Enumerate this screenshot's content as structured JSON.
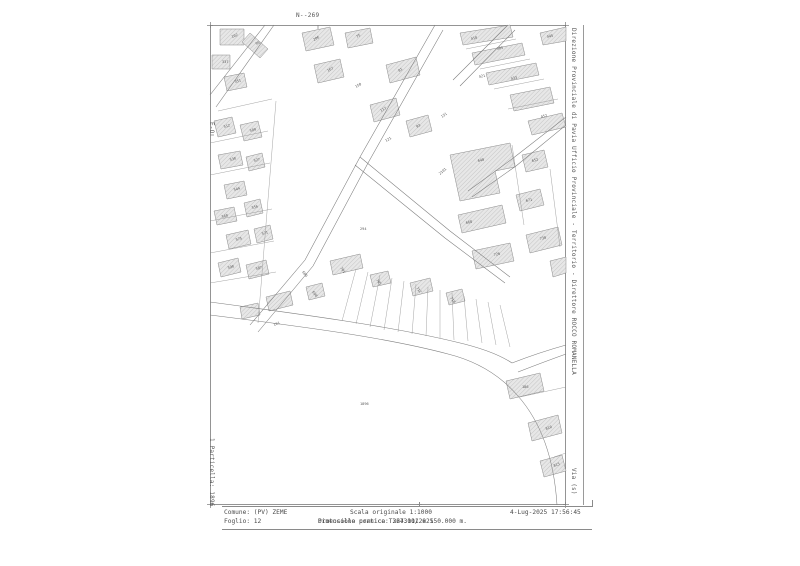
{
  "sheet": {
    "top_grid_label": "N--269",
    "right_margin_text": "Direzione Provinciale di Pavia  Ufficio Provinciale - Territorio - Direttore ROCCO ROMANELLA",
    "right_margin_bottom_text": "Via (s)",
    "left_margin_top_text": "E-O",
    "left_margin_bottom_text": "1 Particella: 1896"
  },
  "footer": {
    "comune": "Comune: (PV) ZEME",
    "foglio": "Foglio: 12",
    "scala": "Scala originale  1:1000",
    "cornice": "Dimensione cornice: 267.001 x 150.000 m.",
    "protocollo": "Protocollo pratica T324311/2025",
    "timestamp": "4-Lug-2025 17:56:45"
  },
  "map": {
    "line_color": "#7c7c7c",
    "building_fill": "#e7e7e7",
    "hatch_color": "#bdbdbd",
    "roads": [
      "M55 0 L0 70",
      "M64 0 L6 82",
      "M225 0 L150 132 L95 235 L40 300",
      "M233 5 L158 138 L103 241 L48 307",
      "M150 132 L240 206 L300 252",
      "M145 140 L235 213 L295 258",
      "M298 0 L243 55",
      "M305 5 L250 61",
      "M356 92 L302 134 L258 166",
      "M356 100 L306 141 L262 172",
      "M0 277 C90 289 180 301 246 317 C272 323 290 330 302 338",
      "M0 290 C88 301 174 312 238 329 C266 336 290 350 308 371 C330 396 344 432 347 480",
      "M302 338 C320 331 338 325 356 320",
      "M308 347 C326 340 342 334 356 329"
    ],
    "buildings": [
      "10,4 34,4 34,20 10,20",
      "40,8 58,24 50,33 32,17",
      "2,30 20,30 20,44 2,44",
      "14,52 34,48 37,62 17,66",
      "4,96 22,92 26,108 8,112",
      "30,100 48,96 52,112 34,116",
      "8,130 30,126 33,140 11,144",
      "36,132 52,128 55,142 39,146",
      "14,160 34,156 37,170 17,174",
      "4,186 24,182 27,196 7,200",
      "34,178 50,174 53,188 37,192",
      "16,210 38,205 41,219 19,224",
      "44,204 60,200 63,214 47,218",
      "8,238 28,233 31,247 11,252",
      "36,240 56,235 59,249 39,254",
      "92,8 120,2 124,20 96,26",
      "104,40 130,34 134,52 108,58",
      "135,8 160,3 163,18 138,23",
      "176,40 206,32 210,50 180,58",
      "160,80 186,73 190,90 164,97",
      "196,96 218,90 222,106 200,112",
      "250,8 300,0 303,12 253,20",
      "262,28 312,18 315,30 265,40",
      "276,48 326,38 329,50 279,60",
      "330,8 356,2 356,16 333,20",
      "300,70 340,62 344,78 304,86",
      "318,96 352,88 356,102 322,110",
      "240,130 300,118 305,142 285,146 290,168 250,176",
      "312,130 334,125 338,142 316,147",
      "248,190 292,180 296,198 252,208",
      "306,170 330,164 334,180 310,186",
      "120,236 150,229 153,243 123,250",
      "160,250 178,246 181,258 163,262",
      "200,258 220,253 223,266 203,271",
      "236,268 252,264 255,276 239,280",
      "96,262 112,258 115,271 99,275",
      "262,226 300,218 304,236 266,244",
      "316,210 348,202 352,220 320,228",
      "296,356 330,348 334,366 300,374",
      "318,398 348,390 352,408 322,416",
      "330,436 352,430 356,446 334,452",
      "56,272 80,266 83,280 59,286",
      "30,282 48,278 50,290 32,294",
      "340,236 356,232 356,248 343,252"
    ],
    "parcel_lines": [
      [
        146,
        244,
        132,
        296
      ],
      [
        158,
        247,
        146,
        299
      ],
      [
        170,
        250,
        160,
        302
      ],
      [
        182,
        253,
        174,
        305
      ],
      [
        194,
        256,
        188,
        307
      ],
      [
        206,
        259,
        202,
        309
      ],
      [
        218,
        262,
        216,
        311
      ],
      [
        230,
        265,
        230,
        313
      ],
      [
        242,
        268,
        244,
        315
      ],
      [
        254,
        271,
        258,
        316
      ],
      [
        266,
        274,
        272,
        318
      ],
      [
        278,
        277,
        286,
        320
      ],
      [
        290,
        280,
        300,
        322
      ],
      [
        0,
        118,
        58,
        106
      ],
      [
        0,
        150,
        60,
        138
      ],
      [
        0,
        196,
        62,
        184
      ],
      [
        0,
        228,
        64,
        216
      ],
      [
        0,
        258,
        66,
        247
      ],
      [
        8,
        86,
        62,
        74
      ],
      [
        66,
        76,
        48,
        298
      ],
      [
        256,
        24,
        306,
        14
      ],
      [
        270,
        44,
        320,
        34
      ],
      [
        284,
        64,
        334,
        54
      ],
      [
        298,
        84,
        348,
        74
      ],
      [
        302,
        120,
        314,
        200
      ],
      [
        340,
        144,
        350,
        222
      ],
      [
        310,
        372,
        356,
        362
      ],
      [
        344,
        432,
        356,
        428
      ]
    ],
    "labels": [
      {
        "x": 22,
        "y": 13,
        "t": "102",
        "r": -20
      },
      {
        "x": 46,
        "y": 20,
        "t": "99",
        "r": -20
      },
      {
        "x": 12,
        "y": 38,
        "t": "337",
        "r": 0
      },
      {
        "x": 25,
        "y": 58,
        "t": "351",
        "r": -15
      },
      {
        "x": 104,
        "y": 16,
        "t": "206",
        "r": -30
      },
      {
        "x": 118,
        "y": 47,
        "t": "167",
        "r": -30
      },
      {
        "x": 147,
        "y": 13,
        "t": "75",
        "r": -30
      },
      {
        "x": 189,
        "y": 47,
        "t": "81",
        "r": -30
      },
      {
        "x": 171,
        "y": 87,
        "t": "117",
        "r": -30
      },
      {
        "x": 207,
        "y": 103,
        "t": "93",
        "r": -30
      },
      {
        "x": 261,
        "y": 15,
        "t": "410",
        "r": -12
      },
      {
        "x": 287,
        "y": 25,
        "t": "405",
        "r": -12
      },
      {
        "x": 301,
        "y": 55,
        "t": "433",
        "r": -12
      },
      {
        "x": 337,
        "y": 13,
        "t": "445",
        "r": -12
      },
      {
        "x": 331,
        "y": 93,
        "t": "452",
        "r": -12
      },
      {
        "x": 269,
        "y": 53,
        "t": "421",
        "r": -12
      },
      {
        "x": 14,
        "y": 103,
        "t": "512",
        "r": -15
      },
      {
        "x": 40,
        "y": 107,
        "t": "509",
        "r": -15
      },
      {
        "x": 20,
        "y": 136,
        "t": "530",
        "r": -15
      },
      {
        "x": 44,
        "y": 137,
        "t": "527",
        "r": -15
      },
      {
        "x": 24,
        "y": 166,
        "t": "544",
        "r": -15
      },
      {
        "x": 12,
        "y": 193,
        "t": "560",
        "r": -15
      },
      {
        "x": 42,
        "y": 184,
        "t": "556",
        "r": -15
      },
      {
        "x": 26,
        "y": 216,
        "t": "575",
        "r": -15
      },
      {
        "x": 52,
        "y": 210,
        "t": "571",
        "r": -15
      },
      {
        "x": 18,
        "y": 244,
        "t": "590",
        "r": -15
      },
      {
        "x": 46,
        "y": 245,
        "t": "587",
        "r": -15
      },
      {
        "x": 150,
        "y": 205,
        "t": "294",
        "r": 0
      },
      {
        "x": 230,
        "y": 150,
        "t": "2101",
        "r": -40
      },
      {
        "x": 268,
        "y": 137,
        "t": "640",
        "r": -12
      },
      {
        "x": 322,
        "y": 137,
        "t": "652",
        "r": -12
      },
      {
        "x": 256,
        "y": 199,
        "t": "668",
        "r": -12
      },
      {
        "x": 316,
        "y": 177,
        "t": "671",
        "r": -12
      },
      {
        "x": 130,
        "y": 243,
        "t": "701",
        "r": 55
      },
      {
        "x": 166,
        "y": 255,
        "t": "705",
        "r": 55
      },
      {
        "x": 206,
        "y": 263,
        "t": "712",
        "r": 55
      },
      {
        "x": 240,
        "y": 273,
        "t": "718",
        "r": 55
      },
      {
        "x": 102,
        "y": 267,
        "t": "698",
        "r": 55
      },
      {
        "x": 284,
        "y": 231,
        "t": "726",
        "r": -12
      },
      {
        "x": 330,
        "y": 215,
        "t": "730",
        "r": -12
      },
      {
        "x": 312,
        "y": 363,
        "t": "186",
        "r": 0
      },
      {
        "x": 336,
        "y": 405,
        "t": "810",
        "r": -20
      },
      {
        "x": 344,
        "y": 442,
        "t": "815",
        "r": -20
      },
      {
        "x": 150,
        "y": 380,
        "t": "1896",
        "r": 0
      },
      {
        "x": 64,
        "y": 301,
        "t": "161",
        "r": -20
      },
      {
        "x": 92,
        "y": 247,
        "t": "689",
        "r": 55
      },
      {
        "x": 176,
        "y": 117,
        "t": "121",
        "r": -30
      },
      {
        "x": 232,
        "y": 93,
        "t": "131",
        "r": -35
      },
      {
        "x": 146,
        "y": 63,
        "t": "150",
        "r": -30
      }
    ]
  }
}
